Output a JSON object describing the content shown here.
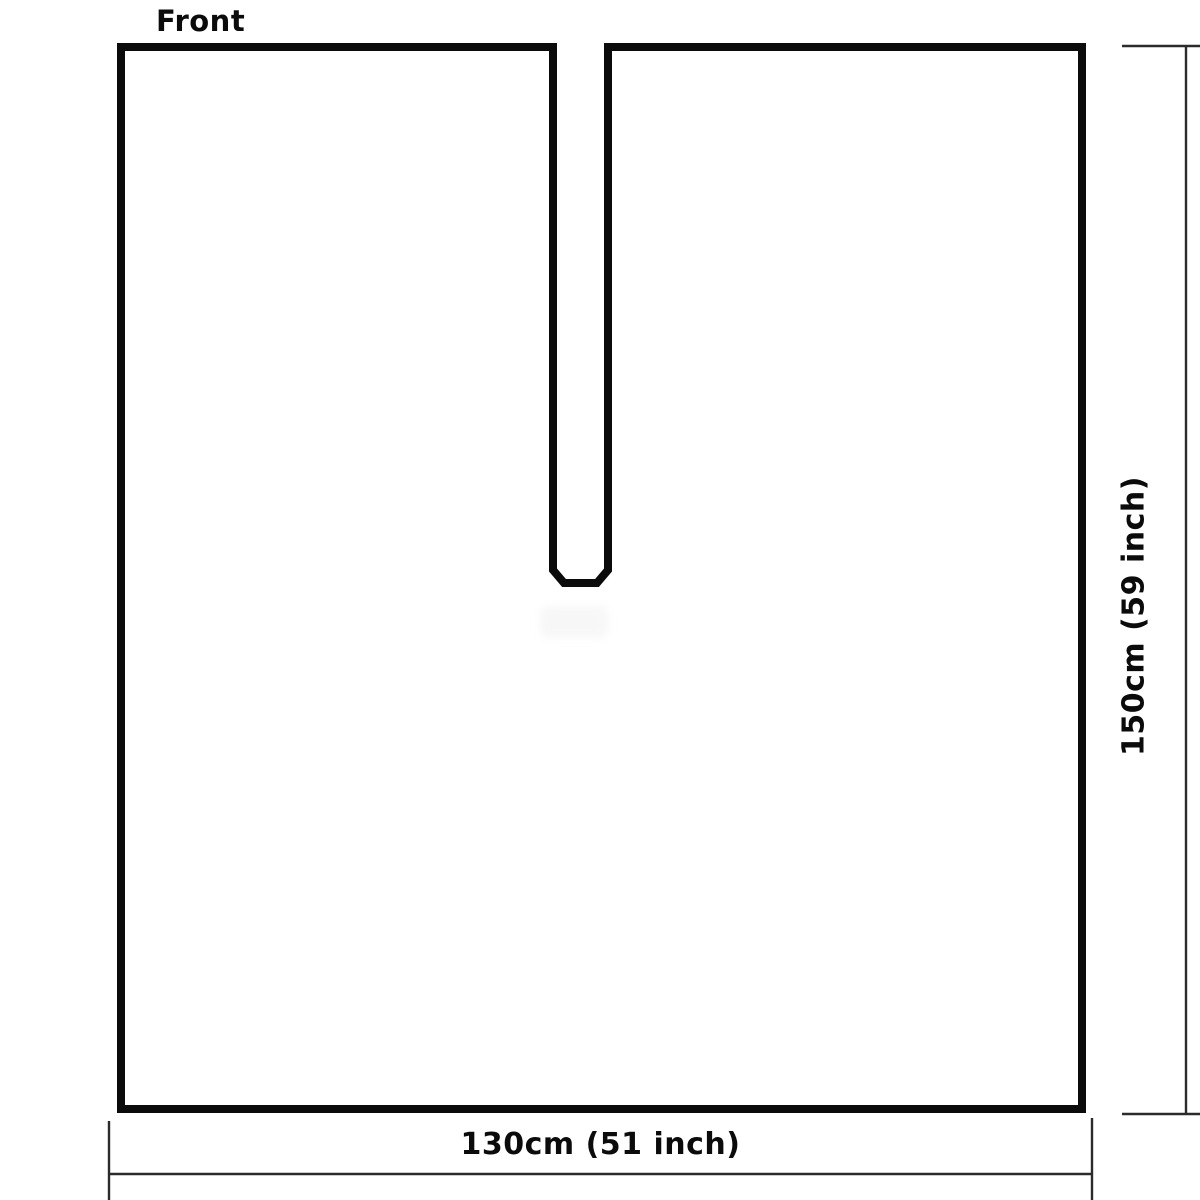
{
  "diagram": {
    "view_label": "Front",
    "width_label": "130cm (51 inch)",
    "height_label": "150cm (59 inch)"
  },
  "colors": {
    "outline": "#0b0b0b",
    "dimension": "#2b2b2b",
    "label-text": "#0b0b0b",
    "background": "#ffffff"
  }
}
